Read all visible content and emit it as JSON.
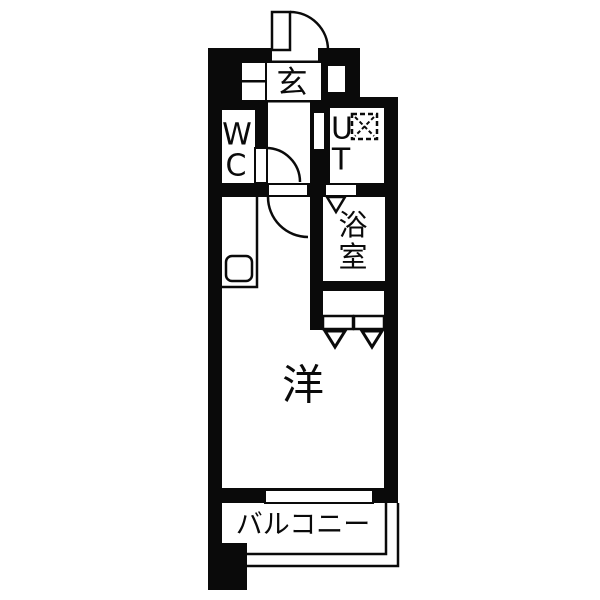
{
  "figure": {
    "type": "floor-plan",
    "style": "black-and-white Japanese apartment plan"
  },
  "colors": {
    "wall": "#0a0a0a",
    "floor": "#ffffff"
  },
  "labels": {
    "entrance": "玄",
    "wc_line1": "W",
    "wc_line2": "C",
    "utility_line1": "U",
    "utility_line2": "T",
    "bath_line1": "浴",
    "bath_line2": "室",
    "living_room": "洋",
    "balcony": "バルコニー"
  },
  "fixtures": {
    "entrance_door": "hinged-door-quarter-arc",
    "wc_door": "hinged-door-quarter-arc",
    "living_room_door": "hinged-door-quarter-arc",
    "utility_door": "wall-opening-leaf",
    "bath_door": "folding-door-v-mark",
    "closet_doors": "bifold-doors-two-v-marks",
    "washing_machine_pan": "dashed-square-with-x",
    "kitchen_sink": "rounded-square",
    "window": "sliding-window-band",
    "balcony_railing": "thin-double-line"
  }
}
